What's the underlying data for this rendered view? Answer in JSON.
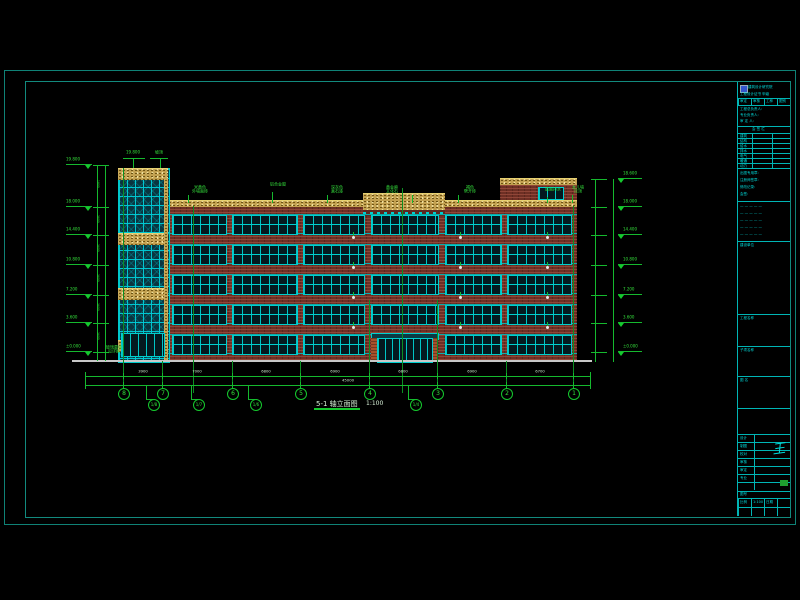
{
  "colors": {
    "background": "#000000",
    "frame_teal": "#0f8276",
    "titleblock_cyan": "#00dcdc",
    "dimension_green": "#15c92e",
    "brick_red": "#6e2f24",
    "band_tan": "#c2a050",
    "window_cyan": "#00cfcf",
    "ground_gray": "#c8c8c8",
    "logo_blue": "#3355cc"
  },
  "drawing": {
    "title": "5-1 轴立面图",
    "scale": "1:100",
    "levels_left": [
      "19.800",
      "18.000",
      "14.400",
      "10.800",
      "7.200",
      "3.600",
      "±0.000"
    ],
    "levels_right": [
      "18.600",
      "18.000",
      "14.400",
      "10.800",
      "7.200",
      "3.600",
      "±0.000"
    ],
    "floor_dims": [
      "1800",
      "3600",
      "3600",
      "3600",
      "3600",
      "3600"
    ],
    "axis_labels": [
      "8",
      "7",
      "6",
      "5",
      "4",
      "3",
      "2",
      "1"
    ],
    "sub_axis_labels": [
      "1/8",
      "1/7",
      "1/6",
      "1/4"
    ],
    "segment_dims": [
      "3900",
      "7000",
      "6800",
      "6900",
      "6800",
      "6900",
      "6700"
    ],
    "total_dim": "45000",
    "tower_top_labels": [
      "19.800",
      "坡顶"
    ],
    "curtain_label": "玻璃幕墙\n见详图",
    "callouts": [
      {
        "text": "米黄色\n外墙面砖"
      },
      {
        "text": "铝合金窗"
      },
      {
        "text": "深灰色\n真石漆"
      },
      {
        "text": "黄金麻\n文化石"
      },
      {
        "text": "褐色\n劈开砖"
      },
      {
        "text": "屋面排水"
      },
      {
        "text": "女儿墙\n压顶"
      }
    ]
  },
  "title_block": {
    "logo_text": "建筑设计研究院",
    "cert_text": "工程设计证书 甲级",
    "header_cells": [
      "审定",
      "审核",
      "工种",
      "图别"
    ],
    "sign_title": "会 签 栏",
    "sign_rows": [
      "建筑",
      "结构",
      "给水",
      "排水",
      "电气",
      "暖通",
      "动力"
    ],
    "notes": [
      "出图专用章:",
      "注册师签章:",
      "修改记录:",
      "会签:"
    ],
    "section_labels": [
      "建设单位",
      "工程名称",
      "子项名称",
      "图 名"
    ],
    "person_rows": [
      "设计",
      "制图",
      "校对",
      "审核",
      "审定",
      "专业"
    ],
    "signature": "王",
    "no_label": "图号",
    "bottom_cells": [
      "比例",
      "1:100",
      "日期",
      ""
    ]
  }
}
